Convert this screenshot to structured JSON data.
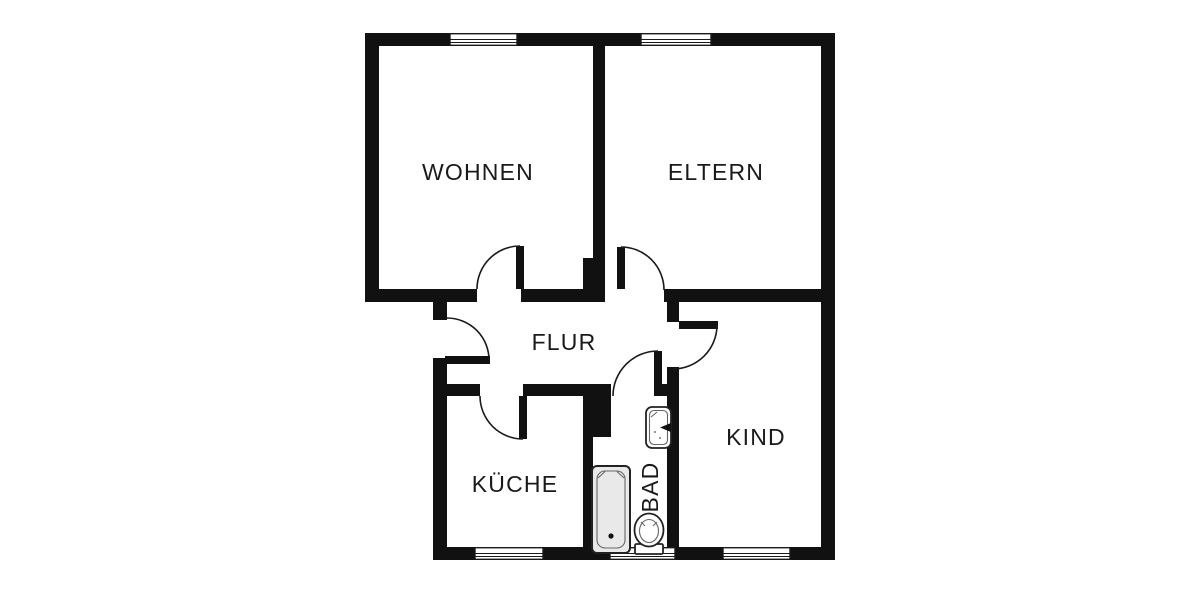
{
  "plan": {
    "type": "apartment-floor-plan",
    "rooms": [
      {
        "id": "wohnen",
        "label": "WOHNEN"
      },
      {
        "id": "eltern",
        "label": "ELTERN"
      },
      {
        "id": "flur",
        "label": "FLUR"
      },
      {
        "id": "kueche",
        "label": "KÜCHE"
      },
      {
        "id": "bad",
        "label": "BAD"
      },
      {
        "id": "kind",
        "label": "KIND"
      }
    ],
    "fixtures": [
      {
        "id": "bathtub-icon"
      },
      {
        "id": "sink-icon"
      },
      {
        "id": "toilet-icon"
      }
    ],
    "openings": {
      "windows": 5,
      "doors": 6
    },
    "colors": {
      "wall": "#111111",
      "background": "#ffffff",
      "fixture_fill": "#e9e9e9",
      "line": "#1a1a1a"
    }
  }
}
